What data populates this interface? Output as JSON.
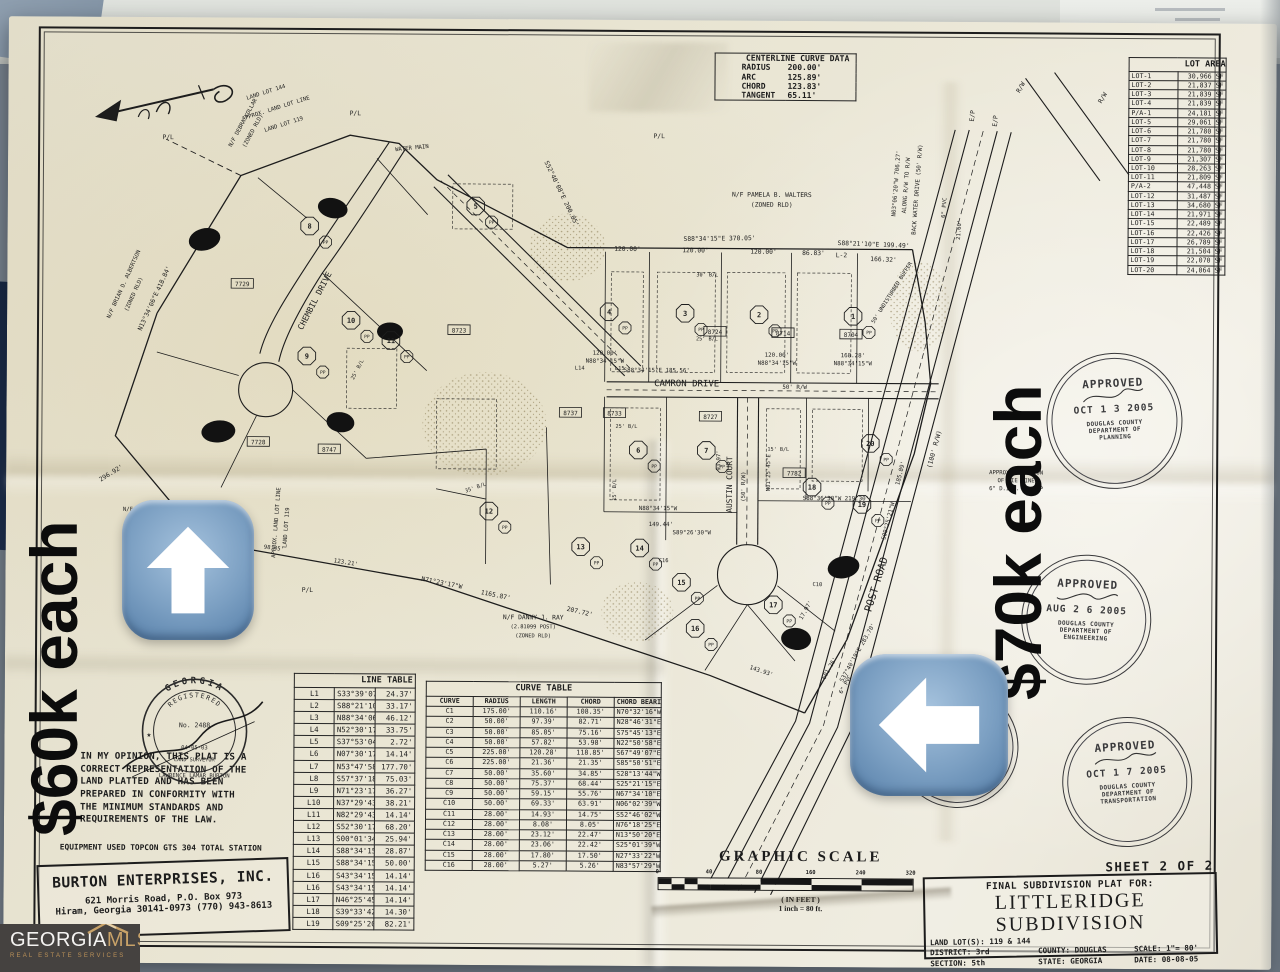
{
  "overlay": {
    "price_left": "$60k each",
    "price_right": "$70k each"
  },
  "logo": {
    "name": "GEORGIA",
    "accent": "MLS",
    "tagline": "REAL ESTATE SERVICES"
  },
  "centerline_curve": {
    "title": "CENTERLINE CURVE DATA",
    "rows": [
      [
        "RADIUS",
        "200.00'"
      ],
      [
        "ARC",
        "125.89'"
      ],
      [
        "CHORD",
        "123.83'"
      ],
      [
        "TANGENT",
        "65.11'"
      ]
    ]
  },
  "lot_area": {
    "title": "LOT AREA",
    "rows": [
      [
        "LOT-1",
        "30,966 SF"
      ],
      [
        "LOT-2",
        "21,837 SF"
      ],
      [
        "LOT-3",
        "21,839 SF"
      ],
      [
        "LOT-4",
        "21,839 SF"
      ],
      [
        "P/A-1",
        "24,181 SF"
      ],
      [
        "LOT-5",
        "29,061 SF"
      ],
      [
        "LOT-6",
        "21,780 SF"
      ],
      [
        "LOT-7",
        "21,780 SF"
      ],
      [
        "LOT-8",
        "21,780 SF"
      ],
      [
        "LOT-9",
        "21,307 SF"
      ],
      [
        "LOT-10",
        "28,263 SF"
      ],
      [
        "LOT-11",
        "21,809 SF"
      ],
      [
        "P/A-2",
        "47,448 SF"
      ],
      [
        "LOT-12",
        "31,487 SF"
      ],
      [
        "LOT-13",
        "34,680 SF"
      ],
      [
        "LOT-14",
        "21,971 SF"
      ],
      [
        "LOT-15",
        "22,489 SF"
      ],
      [
        "LOT-16",
        "22,426 SF"
      ],
      [
        "LOT-17",
        "26,789 SF"
      ],
      [
        "LOT-18",
        "21,504 SF"
      ],
      [
        "LOT-19",
        "22,070 SF"
      ],
      [
        "LOT-20",
        "24,064 SF"
      ]
    ]
  },
  "line_table": {
    "title": "LINE TABLE",
    "rows": [
      [
        "L1",
        "S33°39'07\"W",
        "24.37'"
      ],
      [
        "L2",
        "S88°21'10\"E",
        "33.17'"
      ],
      [
        "L3",
        "N88°34'06\"W",
        "46.12'"
      ],
      [
        "L4",
        "N52°30'17\"W",
        "33.75'"
      ],
      [
        "L5",
        "S37°53'04\"W",
        "2.72'"
      ],
      [
        "L6",
        "N07°30'17\"W",
        "14.14'"
      ],
      [
        "L7",
        "N53°47'58\"E",
        "177.70'"
      ],
      [
        "L8",
        "S57°37'18\"E",
        "75.03'"
      ],
      [
        "L9",
        "N71°23'17\"W",
        "36.27'"
      ],
      [
        "L10",
        "N37°29'43\"E",
        "38.21'"
      ],
      [
        "L11",
        "N82°29'43\"E",
        "14.14'"
      ],
      [
        "L12",
        "S52°30'17\"E",
        "68.20'"
      ],
      [
        "L13",
        "S00°01'34\"W",
        "25.94'"
      ],
      [
        "L14",
        "S88°34'15\"E",
        "28.87'"
      ],
      [
        "L15",
        "S88°34'15\"E",
        "50.00'"
      ],
      [
        "L16",
        "S43°34'15\"E",
        "14.14'"
      ],
      [
        "L16",
        "S43°34'15\"E",
        "14.14'"
      ],
      [
        "L17",
        "N46°25'45\"E",
        "14.14'"
      ],
      [
        "L18",
        "S39°33'42\"E",
        "14.30'"
      ],
      [
        "L19",
        "S09°25'20\"W",
        "82.21'"
      ]
    ]
  },
  "curve_table": {
    "title": "CURVE TABLE",
    "headers": [
      "CURVE",
      "RADIUS",
      "LENGTH",
      "CHORD",
      "CHORD BEARING"
    ],
    "rows": [
      [
        "C1",
        "175.00'",
        "110.16'",
        "108.35'",
        "N70°32'16\"W"
      ],
      [
        "C2",
        "50.00'",
        "97.39'",
        "82.71'",
        "N28°46'31\"E"
      ],
      [
        "C3",
        "50.00'",
        "85.05'",
        "75.16'",
        "S75°45'13\"E"
      ],
      [
        "C4",
        "50.00'",
        "57.82'",
        "53.98'",
        "N22°50'58\"E"
      ],
      [
        "C5",
        "225.00'",
        "120.28'",
        "118.85'",
        "S67°49'07\"E"
      ],
      [
        "C6",
        "225.00'",
        "21.36'",
        "21.35'",
        "S85°50'51\"E"
      ],
      [
        "C7",
        "50.00'",
        "35.60'",
        "34.85'",
        "S28°13'44\"W"
      ],
      [
        "C8",
        "50.00'",
        "75.37'",
        "68.44'",
        "S25°21'15\"E"
      ],
      [
        "C9",
        "50.00'",
        "59.15'",
        "55.76'",
        "N67°34'10\"E"
      ],
      [
        "C10",
        "50.00'",
        "69.33'",
        "63.91'",
        "N06°02'39\"W"
      ],
      [
        "C11",
        "28.00'",
        "14.93'",
        "14.75'",
        "S52°46'02\"W"
      ],
      [
        "C12",
        "28.00'",
        "8.08'",
        "8.05'",
        "N76°18'25\"E"
      ],
      [
        "C13",
        "28.00'",
        "23.12'",
        "22.47'",
        "N13°50'20\"E"
      ],
      [
        "C14",
        "28.00'",
        "23.06'",
        "22.42'",
        "S25°01'39\"W"
      ],
      [
        "C15",
        "28.00'",
        "17.80'",
        "17.50'",
        "N27°33'22\"W"
      ],
      [
        "C16",
        "28.00'",
        "5.27'",
        "5.26'",
        "N83°57'29\"W"
      ]
    ]
  },
  "statement": {
    "lines": [
      "IN MY OPINION,  THIS  PLAT IS A",
      "CORRECT REPRESENTATION OF THE",
      "LAND  PLATTED  AND  HAS  BEEN",
      "PREPARED  IN  CONFORMITY  WITH",
      "THE  MINIMUM  STANDARDS  AND",
      "REQUIREMENTS OF THE LAW."
    ],
    "equipment": "EQUIPMENT USED  TOPCON GTS 304 TOTAL STATION"
  },
  "firm": {
    "name": "BURTON ENTERPRISES, INC.",
    "line1": "621 Morris Road,    P.O. Box 973",
    "line2": "Hiram, Georgia 30141-0973   (770) 943-8613"
  },
  "seal": {
    "arc_top": "GEORGIA",
    "arc_inner": "REGISTERED",
    "no": "No. 2488",
    "date": "04-05-03",
    "star": "★",
    "title": "LAND SURVEYOR",
    "name": "LAWRENCE LAMAR BURTON"
  },
  "stamps": [
    {
      "title": "APPROVED",
      "date": "OCT 1 3 2005",
      "org": "DOUGLAS COUNTY",
      "dept": "DEPARTMENT OF",
      "division": "PLANNING"
    },
    {
      "title": "APPROVED",
      "date": "AUG 2 6 2005",
      "org": "DOUGLAS COUNTY",
      "dept": "DEPARTMENT OF",
      "division": "ENGINEERING"
    },
    {
      "title": "APPROVED",
      "date": "OCT 1 7 2005",
      "org": "DOUGLAS COUNTY",
      "dept": "DEPARTMENT OF",
      "division": "TRANSPORTATION"
    },
    {
      "title": "APPROVED",
      "date": "2005",
      "org": "COUNTY",
      "dept": "DEPARTMENT",
      "division": ""
    }
  ],
  "graphic_scale": {
    "title": "GRAPHIC SCALE",
    "ticks": [
      "0",
      "40",
      "80",
      "160",
      "240",
      "320"
    ],
    "unit_note": "( IN FEET )",
    "ratio_note": "1 inch = 80  ft."
  },
  "title_block": {
    "sheet": "SHEET 2 OF 2",
    "for_line": "FINAL SUBDIVISION PLAT FOR:",
    "name": "LITTLERIDGE  SUBDIVISION",
    "land_lots": "LAND LOT(S): 119 & 144",
    "district": "DISTRICT: 3rd",
    "section": "SECTION: 5th",
    "county": "COUNTY: DOUGLAS",
    "state": "STATE: GEORGIA",
    "scale": "SCALE: 1\"= 80'",
    "date": "DATE: 08-08-05"
  },
  "map": {
    "labels": [
      {
        "t": "S52°40'08\"E  200.05'",
        "x": 552,
        "y": 175,
        "r": 64
      },
      {
        "t": "S88°34'15\"E   370.05'",
        "x": 712,
        "y": 220,
        "r": -1
      },
      {
        "t": "120.00'",
        "x": 620,
        "y": 231,
        "r": 0
      },
      {
        "t": "120.00'",
        "x": 688,
        "y": 232,
        "r": 0
      },
      {
        "t": "120.00'",
        "x": 756,
        "y": 233,
        "r": 0
      },
      {
        "t": "86.83'",
        "x": 806,
        "y": 234,
        "r": 0
      },
      {
        "t": "L-2",
        "x": 834,
        "y": 236,
        "r": 0
      },
      {
        "t": "S88°21'10\"E  199.49'",
        "x": 866,
        "y": 225,
        "r": 2
      },
      {
        "t": "166.32'",
        "x": 876,
        "y": 240,
        "r": 2
      },
      {
        "t": "N/F PAMELA B. WALTERS",
        "x": 764,
        "y": 176,
        "r": 0
      },
      {
        "t": "(ZONED RLD)",
        "x": 764,
        "y": 186,
        "r": 0
      },
      {
        "t": "N03°06'20\"W  706.27'",
        "x": 890,
        "y": 162,
        "r": -86,
        "s": 5.8
      },
      {
        "t": "ALONG R/W TO R/W",
        "x": 900,
        "y": 164,
        "r": -86,
        "s": 5.8
      },
      {
        "t": "BACK WATER DRIVE (50' R/W)",
        "x": 911,
        "y": 168,
        "r": -86,
        "s": 5.8
      },
      {
        "t": "6\" PVC",
        "x": 938,
        "y": 186,
        "r": -86,
        "s": 5.6
      },
      {
        "t": "21.60'",
        "x": 953,
        "y": 208,
        "r": -86,
        "s": 5.6
      },
      {
        "t": "E/P",
        "x": 966,
        "y": 94,
        "r": -86
      },
      {
        "t": "E/P",
        "x": 989,
        "y": 99,
        "r": -86
      },
      {
        "t": "R/W",
        "x": 1014,
        "y": 66,
        "r": -60
      },
      {
        "t": "R/W",
        "x": 1096,
        "y": 76,
        "r": -60
      },
      {
        "t": "N13°34'06\"E",
        "x": 143,
        "y": 295,
        "r": -66
      },
      {
        "t": "418.84'",
        "x": 158,
        "y": 262,
        "r": -66
      },
      {
        "t": "296.92'",
        "x": 106,
        "y": 458,
        "r": -32
      },
      {
        "t": "N/F BRIAN D. ALBERTSON",
        "x": 118,
        "y": 268,
        "r": -66,
        "s": 5.6
      },
      {
        "t": "(ZONED RLD)",
        "x": 128,
        "y": 278,
        "r": -66,
        "s": 5.6
      },
      {
        "t": "N/F BRIAN D. ALBERTSON",
        "x": 154,
        "y": 494,
        "r": 0,
        "s": 5.6
      },
      {
        "t": "N/F DEBRA KOLLAR",
        "x": 236,
        "y": 106,
        "r": -62,
        "s": 5.6
      },
      {
        "t": "(ZONED RLD)",
        "x": 246,
        "y": 114,
        "r": -62,
        "s": 5.6
      },
      {
        "t": "LAND LOT 144",
        "x": 258,
        "y": 76,
        "r": -18,
        "s": 5.6
      },
      {
        "t": "APPROX. LAND LOT LINE",
        "x": 268,
        "y": 92,
        "r": -18,
        "s": 5.6
      },
      {
        "t": "LAND LOT 119",
        "x": 276,
        "y": 108,
        "r": -18,
        "s": 5.6
      },
      {
        "t": "WATER MAIN",
        "x": 404,
        "y": 131,
        "r": -6,
        "s": 5.6
      },
      {
        "t": "P/L",
        "x": 347,
        "y": 97,
        "r": 0
      },
      {
        "t": "P/L",
        "x": 160,
        "y": 122,
        "r": 0
      },
      {
        "t": "P/L",
        "x": 651,
        "y": 118,
        "r": 0
      },
      {
        "t": "P/L",
        "x": 302,
        "y": 574,
        "r": 0
      },
      {
        "t": "APPROX. LAND LOT LINE",
        "x": 272,
        "y": 505,
        "r": -86,
        "s": 5.6
      },
      {
        "t": "LAND LOT 119",
        "x": 282,
        "y": 510,
        "r": -86,
        "s": 5.6
      },
      {
        "t": "CHEMBIL  DRIVE",
        "x": 310,
        "y": 284,
        "r": -63,
        "s": 8.2
      },
      {
        "t": "CAMRON  DRIVE",
        "x": 680,
        "y": 366,
        "r": 0,
        "s": 9
      },
      {
        "t": "50' R/W",
        "x": 788,
        "y": 368,
        "r": 0,
        "s": 5.8
      },
      {
        "t": "S88°34'15\"E  185.56'",
        "x": 650,
        "y": 352,
        "r": 0,
        "s": 5.8
      },
      {
        "t": "120.00'",
        "x": 598,
        "y": 335,
        "r": 0,
        "s": 5.8
      },
      {
        "t": "N88°34'15\"W",
        "x": 598,
        "y": 343,
        "r": 0,
        "s": 5.8
      },
      {
        "t": "120.00'",
        "x": 770,
        "y": 336,
        "r": 0,
        "s": 5.8
      },
      {
        "t": "N88°34'15\"W",
        "x": 770,
        "y": 344,
        "r": 0,
        "s": 5.8
      },
      {
        "t": "168.28'",
        "x": 846,
        "y": 336,
        "r": 0,
        "s": 5.8
      },
      {
        "t": "N88°34'15\"W",
        "x": 846,
        "y": 344,
        "r": 0,
        "s": 5.8
      },
      {
        "t": "AUSTIN  COURT",
        "x": 726,
        "y": 464,
        "r": -90,
        "s": 7.8
      },
      {
        "t": "(50' R/W)",
        "x": 739,
        "y": 466,
        "r": -90,
        "s": 5.6
      },
      {
        "t": "93.97'",
        "x": 714,
        "y": 440,
        "r": -90,
        "s": 5.6
      },
      {
        "t": "N01°25'45\"E",
        "x": 764,
        "y": 452,
        "r": -90,
        "s": 5.6
      },
      {
        "t": "POST  ROAD",
        "x": 874,
        "y": 564,
        "r": -73,
        "s": 10.5
      },
      {
        "t": "(100' R/W)",
        "x": 930,
        "y": 428,
        "r": -75,
        "s": 6.5
      },
      {
        "t": "S09°25'21\"W",
        "x": 884,
        "y": 500,
        "r": -76,
        "s": 5.8
      },
      {
        "t": "185.89'",
        "x": 896,
        "y": 452,
        "r": -76,
        "s": 5.8
      },
      {
        "t": "6\" PVC",
        "x": 842,
        "y": 664,
        "r": -62,
        "s": 5.6
      },
      {
        "t": "N71°23'17\"W",
        "x": 436,
        "y": 566,
        "r": 11
      },
      {
        "t": "1165.87'",
        "x": 490,
        "y": 578,
        "r": 11
      },
      {
        "t": "207.72'",
        "x": 574,
        "y": 594,
        "r": 13
      },
      {
        "t": "123.21'",
        "x": 340,
        "y": 546,
        "r": 9,
        "s": 5.8
      },
      {
        "t": "98.45'",
        "x": 268,
        "y": 532,
        "r": 7,
        "s": 5.6
      },
      {
        "t": "N/F DANNY J. RAY",
        "x": 528,
        "y": 600,
        "r": 0
      },
      {
        "t": "(2.81099 POST)",
        "x": 528,
        "y": 609,
        "r": 0,
        "s": 5.4
      },
      {
        "t": "(ZONED RLD)",
        "x": 528,
        "y": 618,
        "r": 0,
        "s": 5.4
      },
      {
        "t": "S37°40'19\"E  283.70'",
        "x": 854,
        "y": 632,
        "r": -61,
        "s": 5.8
      },
      {
        "t": "601.26'",
        "x": 826,
        "y": 648,
        "r": -61,
        "s": 5.8
      },
      {
        "t": "143.93'",
        "x": 756,
        "y": 652,
        "r": 18,
        "s": 5.8
      },
      {
        "t": "17.97'",
        "x": 802,
        "y": 590,
        "r": -61,
        "s": 5.8
      },
      {
        "t": "S88°36'30\"W   219.30'",
        "x": 830,
        "y": 479,
        "r": 0,
        "s": 5.8
      },
      {
        "t": "S89°26'30\"W",
        "x": 686,
        "y": 514,
        "r": 0,
        "s": 5.8
      },
      {
        "t": "149.44'",
        "x": 655,
        "y": 506,
        "r": 0,
        "s": 5.8
      },
      {
        "t": "N88°34'15\"W",
        "x": 652,
        "y": 490,
        "r": 0,
        "s": 5.8
      },
      {
        "t": "50' UNDISTURBED BUFFER",
        "x": 886,
        "y": 272,
        "r": -58,
        "s": 5.4
      },
      {
        "t": "APPROX. LOCATION",
        "x": 1010,
        "y": 452,
        "r": 0,
        "s": 5.6
      },
      {
        "t": "OF TIE LINE",
        "x": 1010,
        "y": 460,
        "r": 0,
        "s": 5.6
      },
      {
        "t": "6\" D.I.P. TO E/P",
        "x": 1010,
        "y": 468,
        "r": 0,
        "s": 5.6
      },
      {
        "t": "25' B/L",
        "x": 700,
        "y": 320,
        "r": 0,
        "s": 5.2
      },
      {
        "t": "30' B/L",
        "x": 700,
        "y": 256,
        "r": 0,
        "s": 5.2
      },
      {
        "t": "25' B/L",
        "x": 620,
        "y": 408,
        "r": 0,
        "s": 5.2
      },
      {
        "t": "35' B/L",
        "x": 470,
        "y": 470,
        "r": -20,
        "s": 5.2
      },
      {
        "t": "15' B/L",
        "x": 610,
        "y": 470,
        "r": -90,
        "s": 5.2
      },
      {
        "t": "15' B/L",
        "x": 772,
        "y": 430,
        "r": 0,
        "s": 5.2
      },
      {
        "t": "25' B/L",
        "x": 352,
        "y": 352,
        "r": -63,
        "s": 5.2
      },
      {
        "t": "L14",
        "x": 573,
        "y": 350,
        "r": 0,
        "s": 5.4
      },
      {
        "t": "L15",
        "x": 613,
        "y": 350,
        "r": 0,
        "s": 5.4
      },
      {
        "t": "C10",
        "x": 812,
        "y": 565,
        "r": 0,
        "s": 5.4
      },
      {
        "t": "C16",
        "x": 658,
        "y": 542,
        "r": 0,
        "s": 5.4
      }
    ],
    "badges": [
      {
        "n": "1",
        "x": 846,
        "y": 295
      },
      {
        "n": "2",
        "x": 752,
        "y": 294
      },
      {
        "n": "3",
        "x": 678,
        "y": 293
      },
      {
        "n": "4",
        "x": 602,
        "y": 292
      },
      {
        "n": "5",
        "x": 468,
        "y": 187
      },
      {
        "n": "6",
        "x": 632,
        "y": 430
      },
      {
        "n": "7",
        "x": 700,
        "y": 430
      },
      {
        "n": "8",
        "x": 302,
        "y": 208
      },
      {
        "n": "9",
        "x": 300,
        "y": 338
      },
      {
        "n": "10",
        "x": 344,
        "y": 302
      },
      {
        "n": "11",
        "x": 384,
        "y": 322
      },
      {
        "n": "12",
        "x": 483,
        "y": 492
      },
      {
        "n": "13",
        "x": 575,
        "y": 527
      },
      {
        "n": "14",
        "x": 634,
        "y": 528
      },
      {
        "n": "15",
        "x": 676,
        "y": 562
      },
      {
        "n": "16",
        "x": 690,
        "y": 608
      },
      {
        "n": "17",
        "x": 768,
        "y": 584
      },
      {
        "n": "18",
        "x": 806,
        "y": 466
      },
      {
        "n": "19",
        "x": 856,
        "y": 483
      },
      {
        "n": "20",
        "x": 864,
        "y": 422
      }
    ],
    "pp_label": "PP",
    "refs": [
      {
        "t": "7729",
        "x": 235,
        "y": 266
      },
      {
        "t": "7728",
        "x": 252,
        "y": 424
      },
      {
        "t": "8747",
        "x": 323,
        "y": 431
      },
      {
        "t": "8723",
        "x": 452,
        "y": 311
      },
      {
        "t": "8724",
        "x": 708,
        "y": 311
      },
      {
        "t": "8714",
        "x": 776,
        "y": 312
      },
      {
        "t": "8704",
        "x": 844,
        "y": 313
      },
      {
        "t": "8737",
        "x": 564,
        "y": 393
      },
      {
        "t": "8733",
        "x": 608,
        "y": 393
      },
      {
        "t": "8727",
        "x": 704,
        "y": 396
      },
      {
        "t": "7782",
        "x": 788,
        "y": 452
      }
    ]
  }
}
